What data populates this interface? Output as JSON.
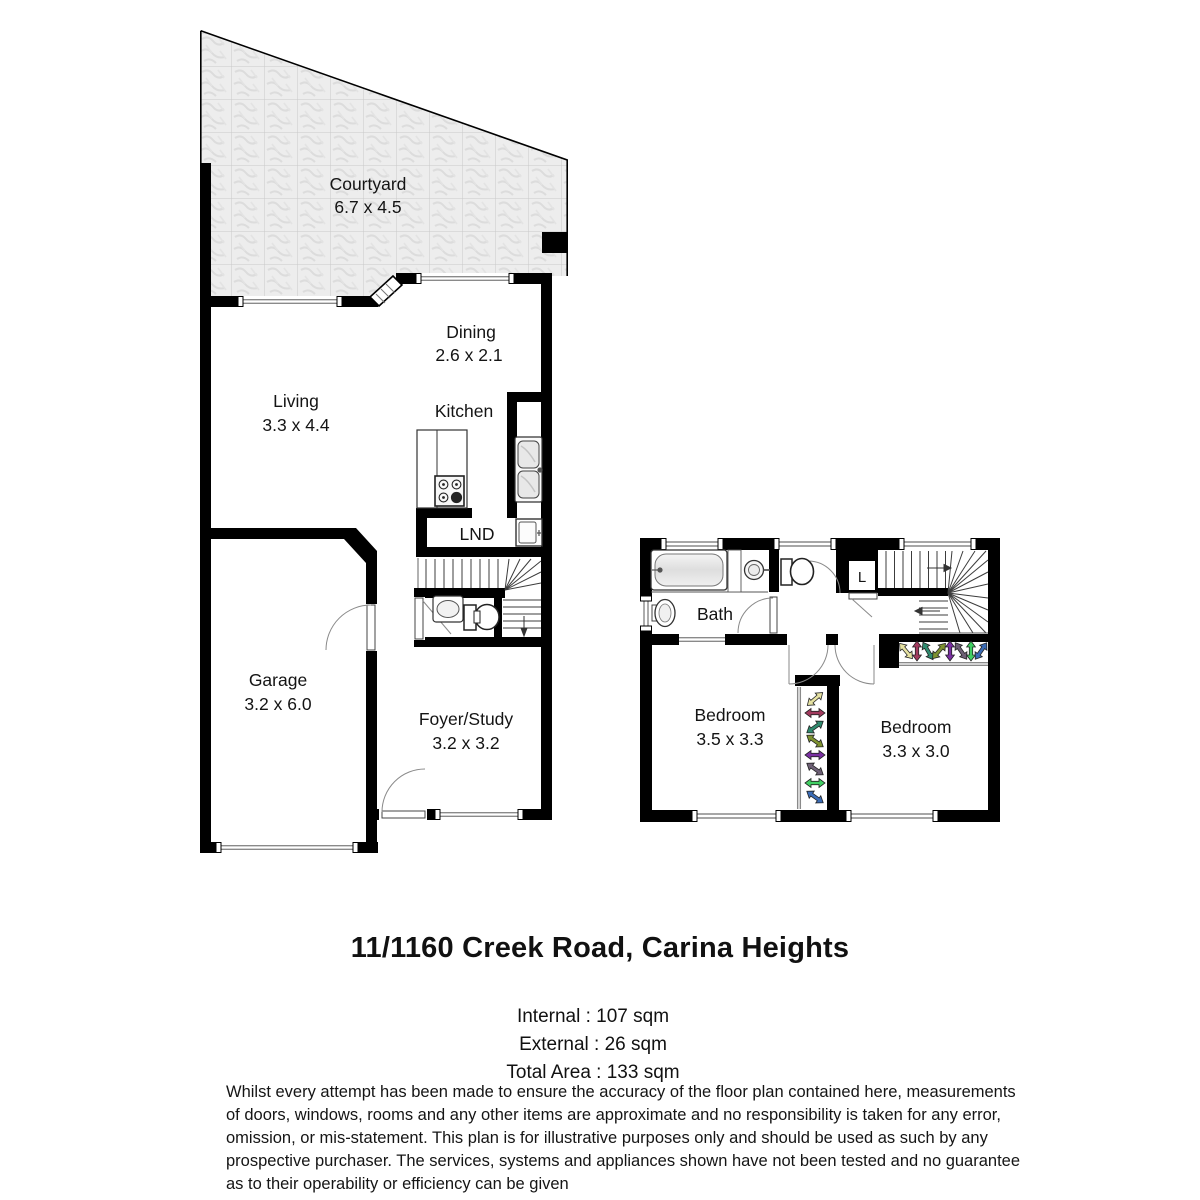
{
  "address_title": "11/1160 Creek Road, Carina Heights",
  "areas": {
    "internal": "Internal : 107 sqm",
    "external": "External : 26 sqm",
    "total": "Total Area : 133 sqm"
  },
  "rooms": {
    "courtyard": {
      "name": "Courtyard",
      "dims": "6.7 x 4.5"
    },
    "living": {
      "name": "Living",
      "dims": "3.3 x 4.4"
    },
    "dining": {
      "name": "Dining",
      "dims": "2.6 x 2.1"
    },
    "kitchen": {
      "name": "Kitchen"
    },
    "laundry": {
      "name": "LND"
    },
    "garage": {
      "name": "Garage",
      "dims": "3.2 x 6.0"
    },
    "foyer": {
      "name": "Foyer/Study",
      "dims": "3.2 x 3.2"
    },
    "bath": {
      "name": "Bath"
    },
    "linen": {
      "name": "L"
    },
    "bedroom_left": {
      "name": "Bedroom",
      "dims": "3.5 x 3.3"
    },
    "bedroom_right": {
      "name": "Bedroom",
      "dims": "3.3 x 3.0"
    }
  },
  "disclaimer": {
    "lines": [
      "Whilst every attempt has been made to ensure the accuracy of the floor plan contained here, measurements",
      "of doors, windows, rooms and any other items are approximate and no responsibility is taken for any error,",
      "omission, or mis-statement. This plan is for illustrative purposes only and should be used as such by any",
      "prospective purchaser. The services, systems and appliances shown have not been tested and no guarantee",
      "as to their operability or efficiency can be given"
    ]
  },
  "colors": {
    "wall": "#000000",
    "window_line": "#8a8a8a",
    "courtyard_tile": "#ededed",
    "courtyard_grid": "#c9c9c9",
    "hangers": [
      "#e6e2a2",
      "#a23a5e",
      "#2f8a6e",
      "#7e9230",
      "#7a2fa2",
      "#6e6076",
      "#41cf63",
      "#3b6cb6"
    ]
  }
}
